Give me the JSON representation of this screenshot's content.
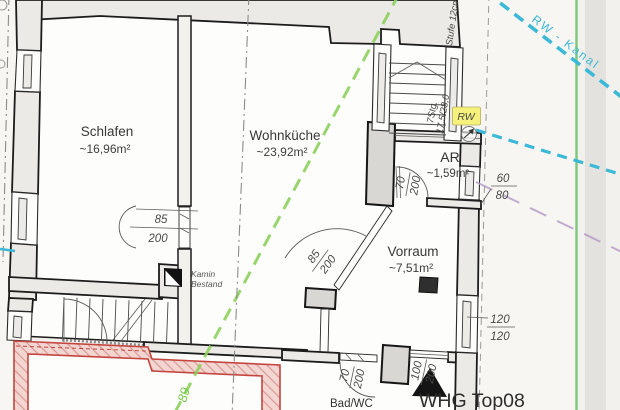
{
  "rooms": {
    "schlafen": {
      "name": "Schlafen",
      "area": "~16,96m²"
    },
    "wohnkueche": {
      "name": "Wohnküche",
      "area": "~23,92m²"
    },
    "ar": {
      "name": "AR",
      "area": "~1,59m²"
    },
    "vorraum": {
      "name": "Vorraum",
      "area": "~7,51m²"
    },
    "bad_wc": {
      "name": "Bad/WC"
    }
  },
  "unit": {
    "label": "WHG Top08"
  },
  "annotations": {
    "kamin_line1": "Kamin",
    "kamin_line2": "Bestand",
    "rw_channel": "RW - Kanal",
    "rw_marker": "RW",
    "step_note": "Stufe 12cm",
    "stair_note_line1": "7Stg.",
    "stair_note_line2": "17,5/28,0",
    "parcel_number": "89"
  },
  "dimensions": {
    "door_schlafen": {
      "w": "85",
      "h": "200"
    },
    "door_diagonal": {
      "w": "85",
      "h": "200"
    },
    "door_ar": {
      "w": "70",
      "h": "200"
    },
    "door_bad": {
      "w": "70",
      "h": "200"
    },
    "door_entry": {
      "w": "100",
      "h": "200"
    },
    "window_ar": {
      "w": "60",
      "h": "80"
    },
    "window_vorraum": {
      "w": "120",
      "h": "120"
    }
  },
  "colors": {
    "boundary_green": "#7cc779",
    "sewer_cyan": "#3cb9d6",
    "survey_purple": "#b79fca",
    "new_wall_red": "#c4453e",
    "highlight_yellow": "#f6f17b",
    "demolition_green": "#8fd05e"
  }
}
